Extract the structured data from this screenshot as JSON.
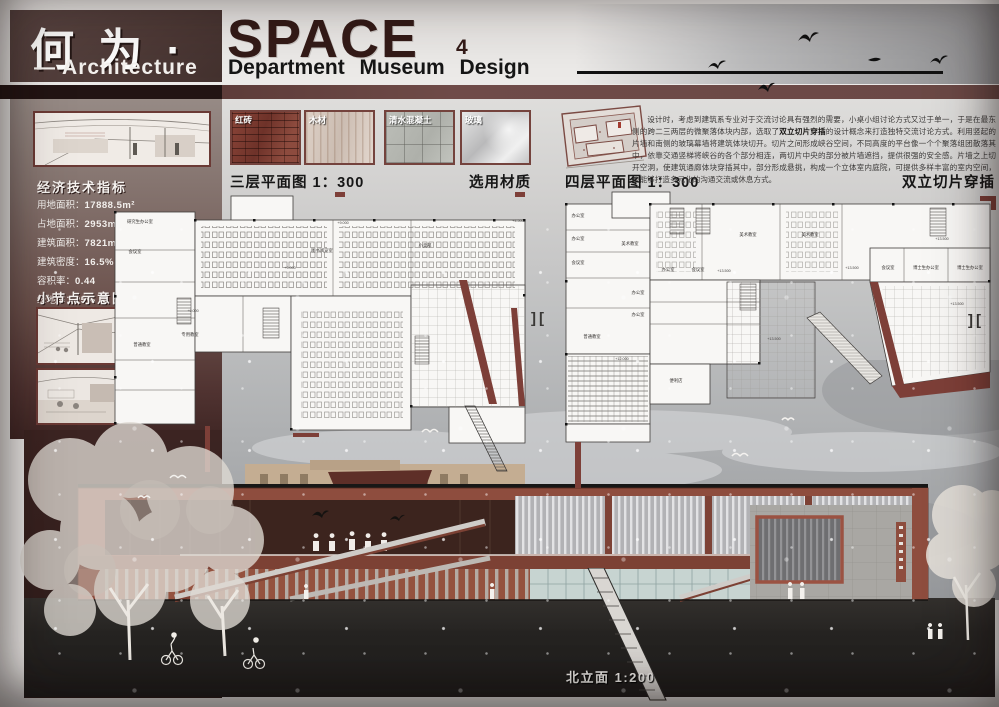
{
  "header": {
    "title_cn": "何 为 ·",
    "title_en": "SPACE",
    "title_num": "4",
    "subtitle_left": "— Architecture",
    "subtitle_right": "Department  Museum  Design"
  },
  "sidebar": {
    "econ_heading": "经济技术指标",
    "econ_stats": [
      {
        "label": "用地面积：",
        "value": "17888.5m²"
      },
      {
        "label": "占地面积：",
        "value": "2953m²"
      },
      {
        "label": "建筑面积：",
        "value": "7821m²"
      },
      {
        "label": "建筑密度：",
        "value": "16.5%"
      },
      {
        "label": "容积率：",
        "value": "0.44"
      },
      {
        "label": "绿地率：",
        "value": "25%"
      }
    ],
    "nodes_heading": "小节点示意图"
  },
  "materials": {
    "section_label": "选用材质",
    "items": [
      {
        "name": "红砖"
      },
      {
        "name": "木材"
      },
      {
        "name": "清水混凝土"
      },
      {
        "name": "玻璃"
      }
    ]
  },
  "plans": {
    "third_label": "三层平面图 1：300",
    "fourth_label": "四层平面图 1：300",
    "concept_label": "双立切片穿插",
    "section_marks": "][",
    "p3_rooms": [
      "研究生办公室",
      "会议室",
      "普通教室",
      "专用教室",
      "图书阅览室",
      "小卖部"
    ],
    "p3_levels": [
      "+9.000",
      "+9.000",
      "+9.000",
      "+4.500"
    ],
    "p4_rooms": [
      "办公室",
      "办公室",
      "会议室",
      "美术教室",
      "美术教室",
      "美术教室",
      "办公室",
      "会议室",
      "会议室",
      "博士生办公室",
      "博士生办公室",
      "办公室",
      "办公室",
      "普通教室",
      "便利店"
    ],
    "p4_levels": [
      "+13.500",
      "+13.500",
      "+13.500",
      "+13.500",
      "+13.500",
      "+12.000"
    ]
  },
  "description": {
    "before": "设计时，考虑到建筑系专业对于交流讨论具有强烈的需要，小桌小组讨论方式又过于单一，于是在最东侧的跨二三两层的微聚落体块内部，选取了",
    "bold": "双立切片穿插",
    "after": "的设计概念来打造独特交流讨论方式。利用竖起的片墙和南侧的玻璃幕墙将建筑体块切开。切片之间形成峡谷空间，不同高度的平台像一个个聚落组团散落其中，依靠交通竖梯将峡谷的各个部分相连，两切片中央的部分被片墙遮挡，提供很强的安全感。片墙之上切开空洞，使建筑通廊体块穿插其中，部分形成悬挑，构成一个立体室内庭院，可提供多样丰富的室内空间，也能够打造多元化的沟通交流或休息方式。"
  },
  "elevation": {
    "label": "北立面 1:200"
  },
  "colors": {
    "accent_maroon": "#7d3f38",
    "header_brown": "#4e3a37",
    "title_maroon": "#341b18",
    "brick_red": "#95503f",
    "ground_dark": "#262422",
    "sky_gray": "#adafb1"
  }
}
